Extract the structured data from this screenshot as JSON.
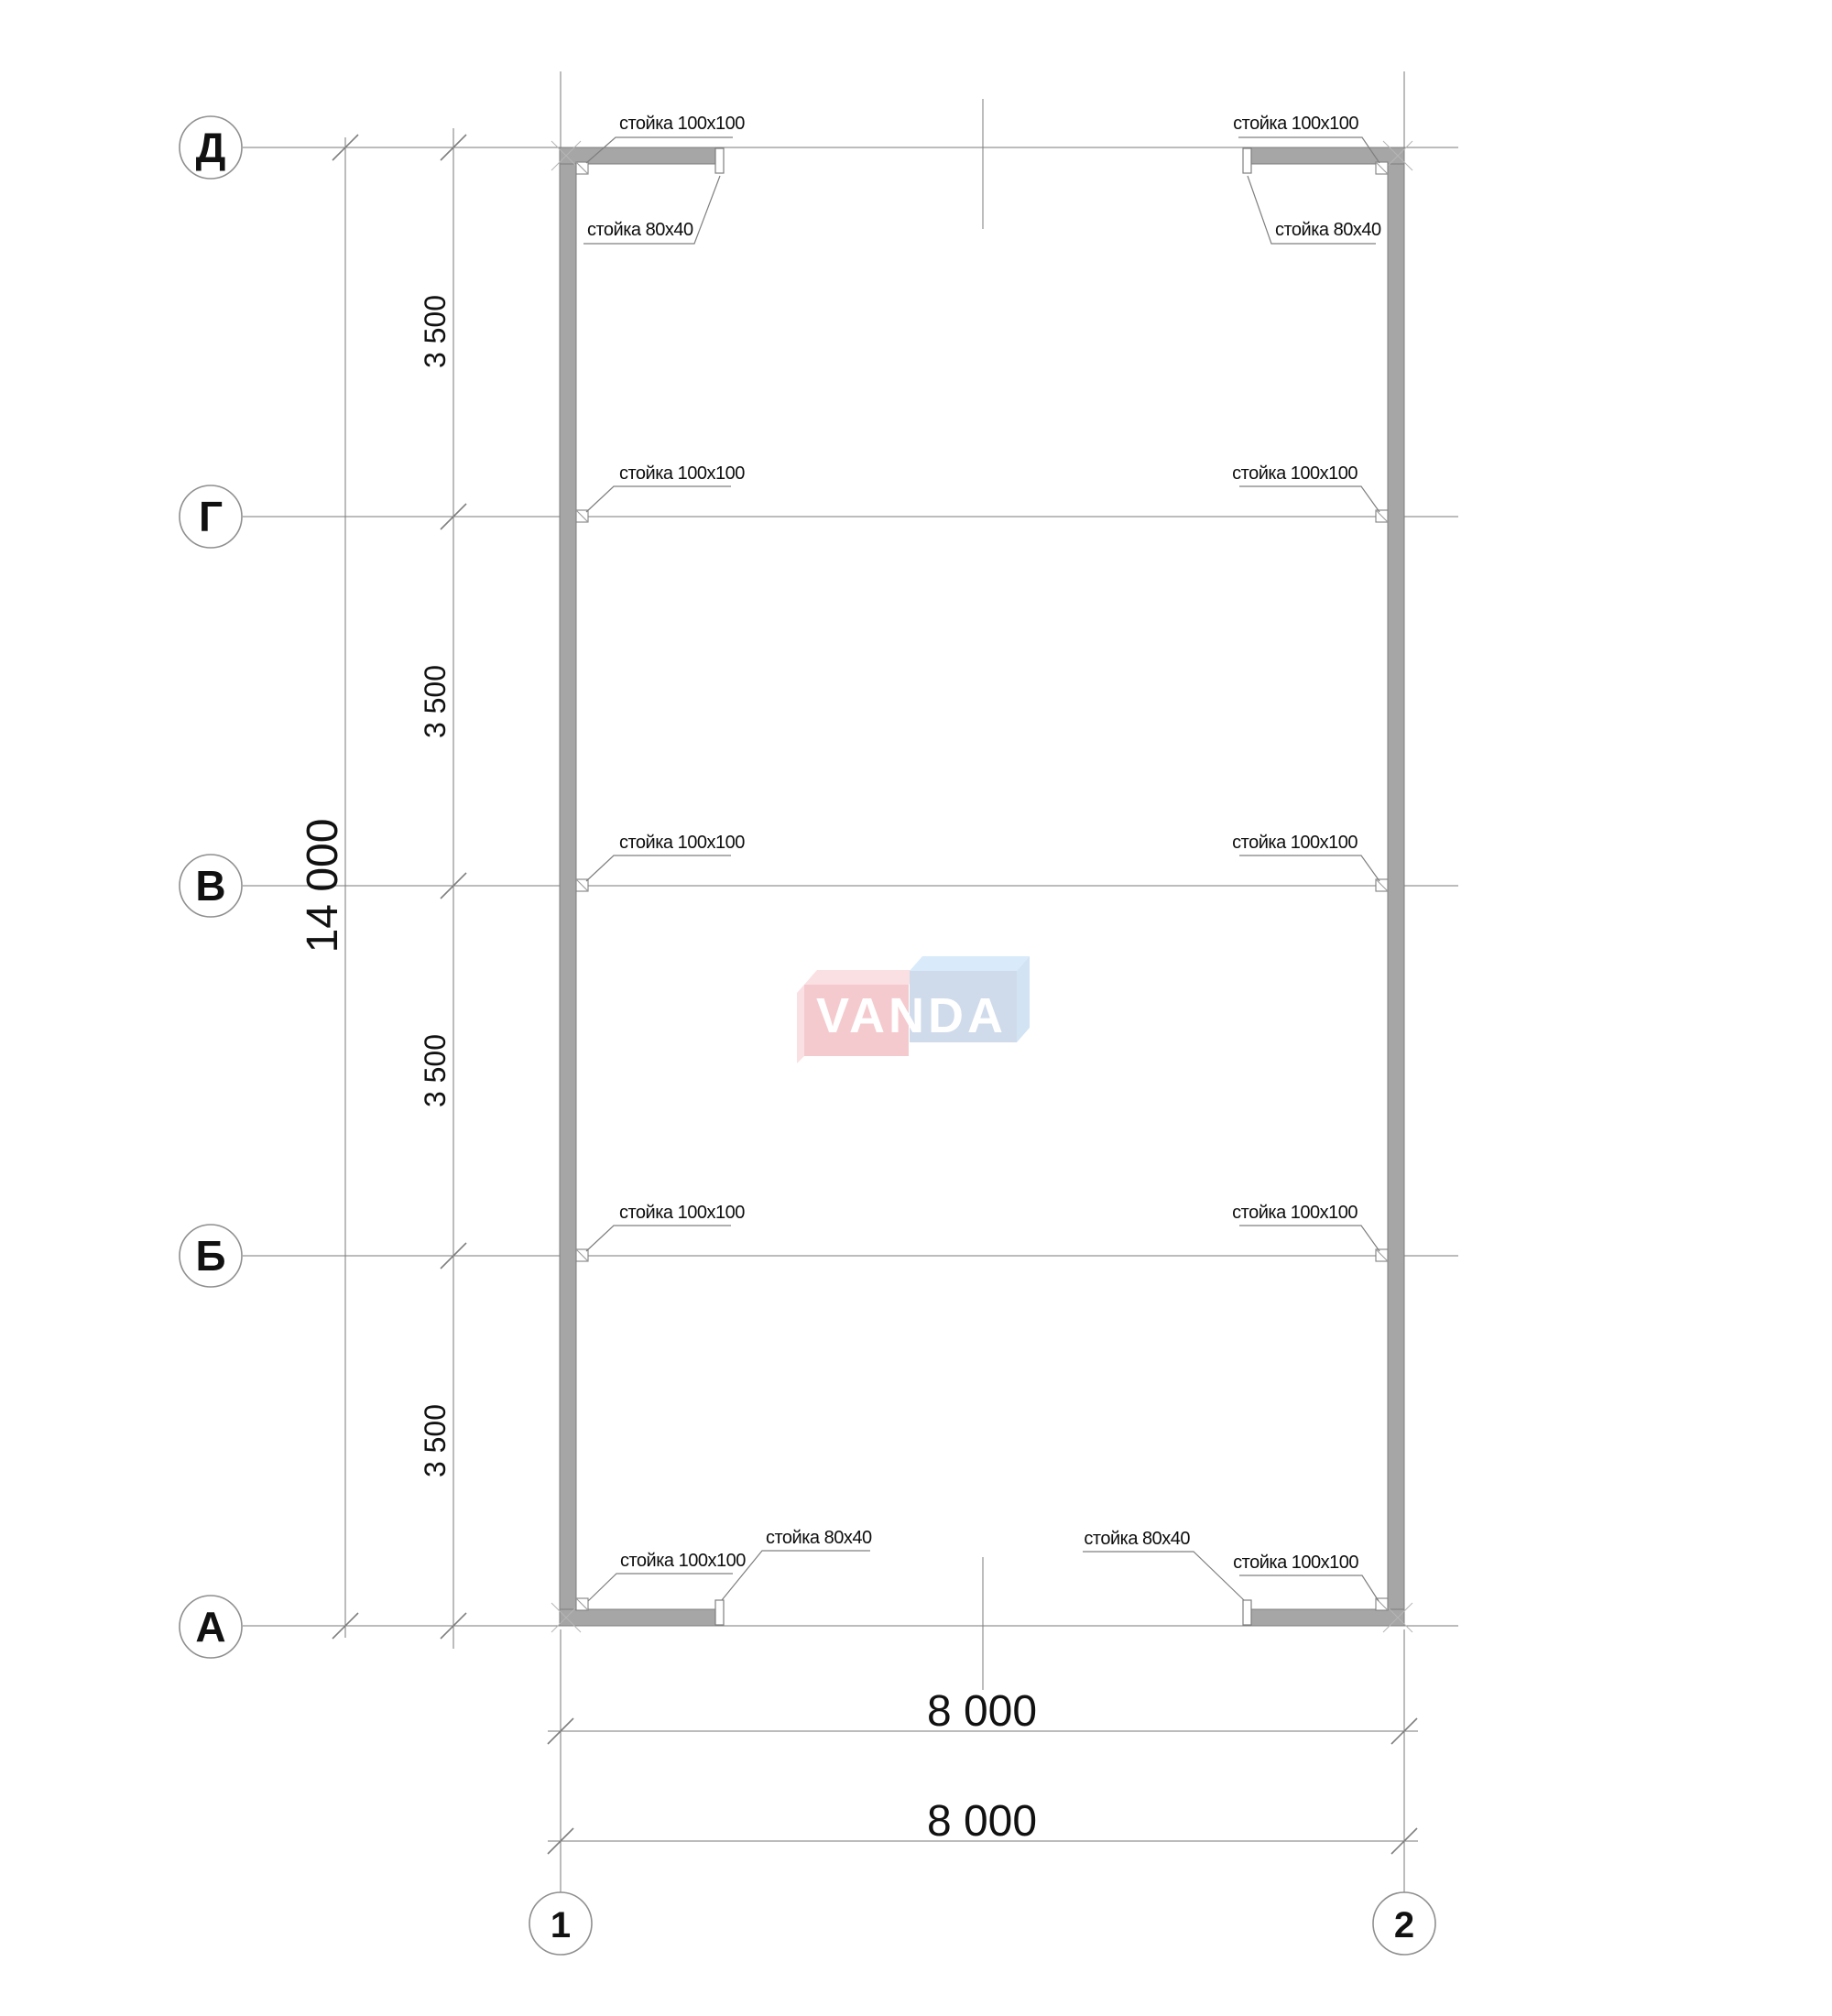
{
  "axes": {
    "rows": [
      "Д",
      "Г",
      "В",
      "Б",
      "А"
    ],
    "cols": [
      "1",
      "2"
    ]
  },
  "dims": {
    "overall_height": "14 000",
    "bays": [
      "3 500",
      "3 500",
      "3 500",
      "3 500"
    ],
    "width_top": "8 000",
    "width_bottom": "8 000"
  },
  "posts": {
    "p100": "стойка 100x100",
    "p80": "стойка 80x40"
  },
  "watermark": {
    "text": "VANDA"
  },
  "colors": {
    "wall": "#a6a6a6",
    "wall_edge": "#7f7f7f",
    "line": "#7a7a7a",
    "text": "#111111",
    "logo_pink_front": "#f4c6ca",
    "logo_pink_top": "#fadde1",
    "logo_blue_front": "#cbd8ea",
    "logo_blue_top": "#d6e9fa",
    "logo_blue_side": "#cfe1f3",
    "logo_letters": "#ffffff"
  }
}
